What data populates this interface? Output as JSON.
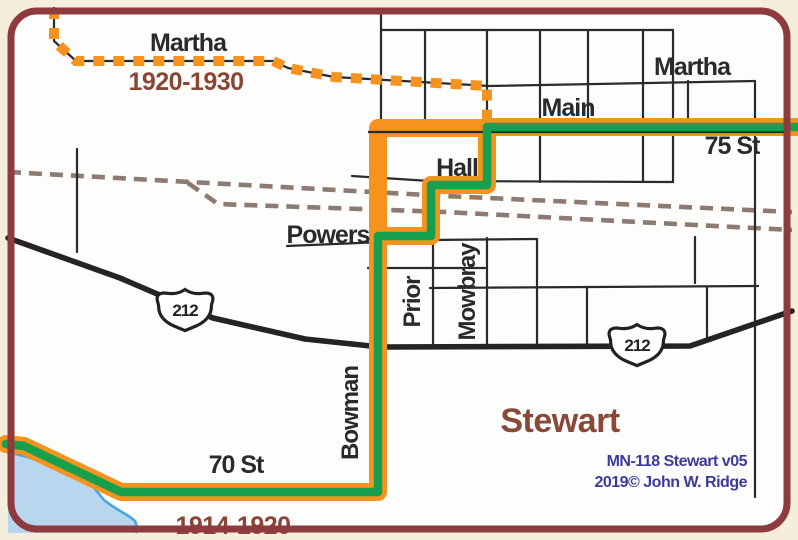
{
  "colors": {
    "page_bg": "#f5eedb",
    "map_bg": "#fdfdfb",
    "border": "#8f3a3c",
    "street": "#2b2a28",
    "highway": "#262422",
    "railroad": "#8d7b71",
    "route_green": "#16a04d",
    "route_orange": "#f6921e",
    "water_fill": "#b9d6ef",
    "water_edge": "#44a5e8",
    "street_label": "#2a2a2a",
    "era_label": "#8a4534",
    "town_label": "#8a4838",
    "credit": "#3b3b9e",
    "shield_fill": "#ffffff",
    "shield_outline": "#242220"
  },
  "labels": {
    "martha_nw": "Martha",
    "era_north": "1920-1930",
    "martha_ne": "Martha",
    "main": "Main",
    "st_75": "75 St",
    "hall": "Hall",
    "powers": "Powers",
    "prior": "Prior",
    "mowbray": "Mowbray",
    "bowman": "Bowman",
    "st_70": "70 St",
    "era_south": "1914-1920"
  },
  "town": {
    "name": "Stewart"
  },
  "credits": {
    "line1": "MN-118 Stewart v05",
    "line2": "2019© John W. Ridge"
  },
  "shields": {
    "west": "212",
    "east": "212"
  }
}
